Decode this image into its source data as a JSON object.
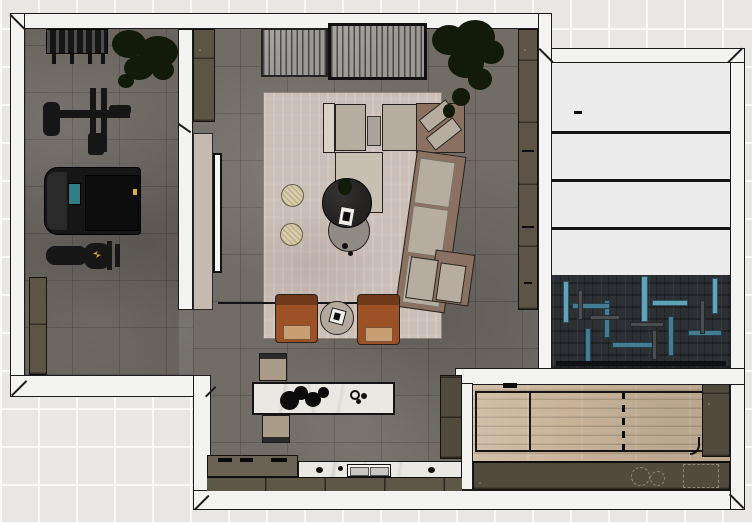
{
  "image": {
    "kind": "interior-floor-plan-render",
    "view": "top-down",
    "width": 752,
    "height": 524
  },
  "palette": {
    "bg": "#e9e7e4",
    "wall": "#f3f3f1",
    "outline": "#1c1c1c",
    "floor_main": "#716c66",
    "floor_gym": "#69645e",
    "rug": "#cbbfb8",
    "sofa_base": "#8b7162",
    "sofa_cushion": "#b6ada0",
    "sofa_arm": "#d9d3c7",
    "sofa_ottoman": "#c6bfb2",
    "chair_cognac": "#9c5126",
    "chair_cushion": "#c89e73",
    "pouf": "#d8cba8",
    "table_dark": "#242221",
    "table_gray": "#8f8b84",
    "side_table": "#b3a99e",
    "media_slat": "#9b9995",
    "cabinet_olive": "#5c5546",
    "cabinet_dark": "#514b3d",
    "island_marble": "#eae8e3",
    "counter_olive": "#6a6355",
    "counter_front": "#5d5748",
    "sink_white": "#f2f1ee",
    "equipment_black": "#161616",
    "treadmill_belt": "#0d0d0d",
    "screen_teal": "#2f7d86",
    "accent_yellow": "#d8b021",
    "plant": "#121a0a",
    "panel_beige": "#c4bab0",
    "tv_white": "#f5f5f4",
    "storage_white": "#ececec",
    "herringbone_base": "#2c2f33",
    "herringbone_teal": "#447d92",
    "herringbone_teal_light": "#5fa3b8",
    "herringbone_gray": "#4a4e52",
    "wood": "#c9b49a",
    "stool": "#ab9c8a"
  },
  "rooms": {
    "gym": {
      "name": "home-gym",
      "floor": "dark-tile",
      "items": [
        "dumbbell-rack",
        "potted-plant",
        "strength-machine",
        "treadmill",
        "weight-bench",
        "storage-cabinet"
      ]
    },
    "living_room": {
      "name": "living-room",
      "floor": "dark-tile",
      "items": [
        "slatted-sideboard",
        "slatted-sideboard-framed",
        "tall-plant",
        "area-rug",
        "sectional-sofa",
        "ottoman",
        "pouf",
        "pouf",
        "round-coffee-table-dark",
        "round-coffee-table-gray",
        "lounge-chair",
        "lounge-chair",
        "round-side-table",
        "tv-panel",
        "wall-shelf-unit",
        "corner-cabinet"
      ]
    },
    "kitchen": {
      "name": "kitchen",
      "floor": "dark-tile",
      "items": [
        "island",
        "bar-stool",
        "bar-stool",
        "cooktop-counter",
        "sink-counter",
        "tall-cabinet",
        "decor-cluster"
      ]
    },
    "storage_room": {
      "name": "storage-room",
      "floor": "white-panels",
      "items": [
        "shelf-band",
        "shelf-band",
        "shelf-band",
        "shelf-band"
      ]
    },
    "hall": {
      "name": "herringbone-hall",
      "floor": "teal-herringbone",
      "items": []
    },
    "wood_room": {
      "name": "wood-floor-room",
      "floor": "light-wood-plank",
      "items": [
        "framed-wood-panel",
        "wardrobe",
        "sideboard",
        "decor-tray",
        "sliding-track-dashes"
      ]
    }
  }
}
